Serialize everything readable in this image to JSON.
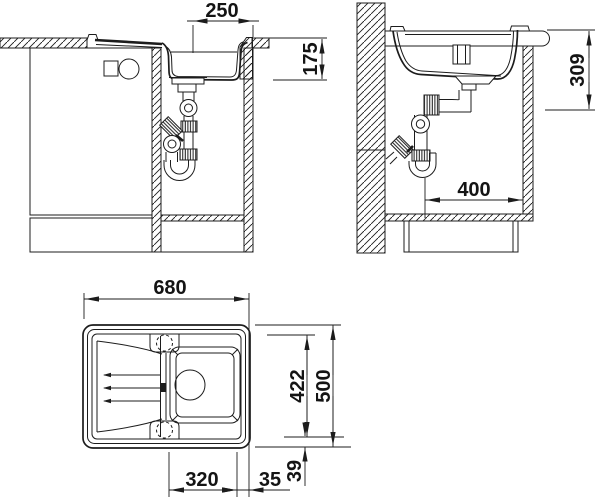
{
  "drawing": {
    "background": "#ffffff",
    "line_color": "#1c1c1c",
    "front_view": {
      "bowl_width": "250",
      "bowl_depth": "175"
    },
    "side_view": {
      "install_depth": "309",
      "drain_offset": "400"
    },
    "top_view": {
      "overall_length": "680",
      "overall_width": "500",
      "inner_width": "422",
      "bowl_length": "320",
      "bowl_side_gap": "35",
      "bowl_bottom_gap": "39"
    }
  }
}
